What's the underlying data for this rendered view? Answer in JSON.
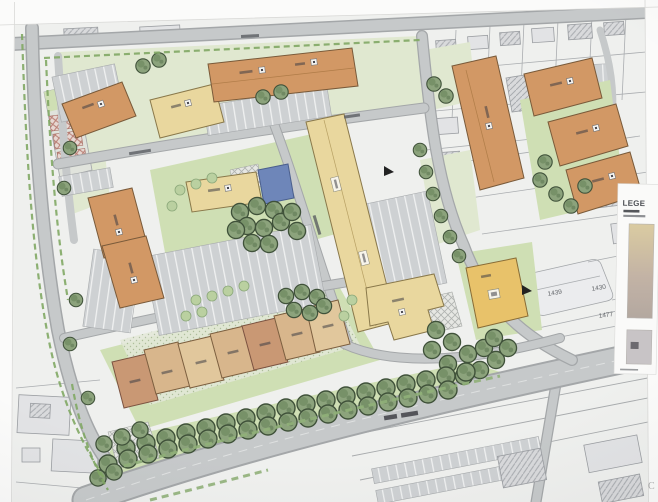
{
  "plan": {
    "legend": {
      "title": "LEGE",
      "swatch_top_color": "#dbcb9f",
      "swatch_bottom_color": "#b3a8a0",
      "swatch2_color": "#c8c4c6"
    },
    "parcels": {
      "n1": "1439",
      "n2": "1430",
      "n3": "1477"
    },
    "margin_letter": "C"
  },
  "colors": {
    "page": "#fbfbfa",
    "paper": "#eff0ee",
    "road": "#c6c9ca",
    "road_edge": "#a4a7a9",
    "residential_orange": "#d49862",
    "residential_cream": "#ead79c",
    "residential_gold": "#e9c266",
    "townhouse_tan": "#d9b68a",
    "townhouse_peach": "#cb9872",
    "townhouse_light": "#e2c79a",
    "lawn": "#cfdfb3",
    "lawn_light": "#e0e8cf",
    "tree_fill": "#8ba37b",
    "tree_line": "#3f5239",
    "hedge": "#8fb077",
    "bike_dash": "#7fa862",
    "water_blue": "#6d86bb",
    "context_fill": "#e2e3e5",
    "context_line": "#9b9ea2",
    "ink": "#3e3e46"
  }
}
